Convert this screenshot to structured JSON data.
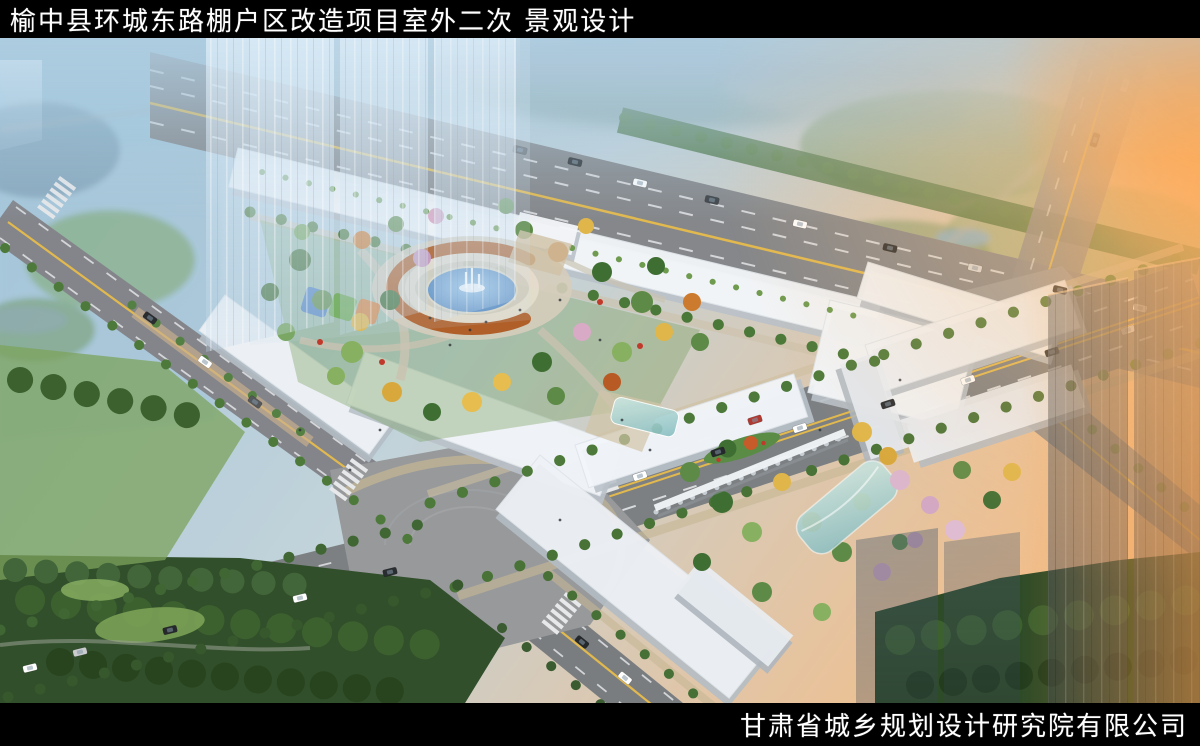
{
  "header": {
    "title": "榆中县环城东路棚户区改造项目室外二次 景观设计"
  },
  "footer": {
    "company": "甘肃省城乡规划设计研究院有限公司"
  },
  "scene": {
    "type": "aerial-landscape-rendering",
    "palette": {
      "bar_black": "#000000",
      "title_text": "#ffffff",
      "sky_haze": "#a9c9de",
      "sun_glow": "#f5a752",
      "road_asphalt": "#85878a",
      "lane_yellow": "#e2b94e",
      "lane_white": "#e8eaec",
      "building_white": "#f3f6f9",
      "tree_green": "#4d7a3a",
      "autumn_yellow": "#e0b64a",
      "autumn_orange": "#cc7a2e",
      "blossom_pink": "#d9aac6",
      "fountain_water": "#5e93cc",
      "pergola_rust": "#b05f28",
      "park_dark_green": "#314f2a",
      "playground_blue": "#4a7fc0",
      "playground_green": "#6aa84f",
      "playground_orange": "#d98440"
    }
  }
}
